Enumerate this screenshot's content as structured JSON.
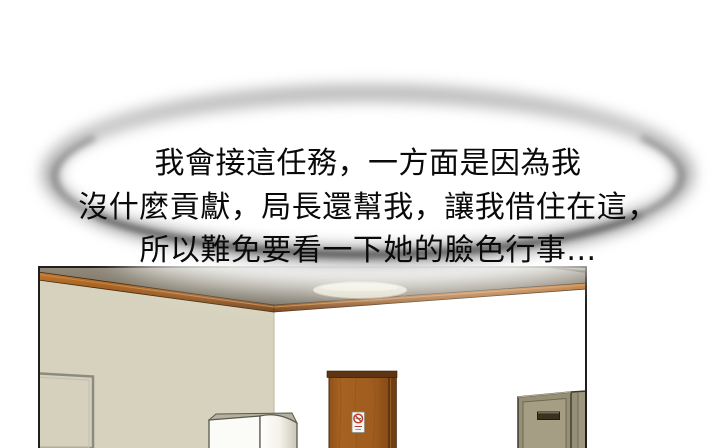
{
  "speech": {
    "lines": [
      "我會接這任務，一方面是因為我",
      "沒什麼貢獻，局長還幫我，讓我借住在這，",
      "所以難免要看一下她的臉色行事..."
    ],
    "text_color": "#0a0a0a",
    "bubble_fill": "#ffffff",
    "bubble_ring_color": "#8e8e8e",
    "bubble_bottom_arc_color": "#3c3c3c"
  },
  "panel": {
    "border_color": "#1f1f1f",
    "room": {
      "colors": {
        "left_wall": "#d7d2bd",
        "right_wall": "#ffffff",
        "ceiling_dark": "#6f6859",
        "molding_wood": "#a35c1e",
        "door_wood": "#a05d1e",
        "door_frame": "#5e3514",
        "left_door_fill": "#d6d1bc",
        "left_door_frame": "#8b8b7f",
        "white_cabinet_front": "#fbfbf8",
        "cabinet_top_face": "#b5b1a1",
        "storage_cabinet_body": "#968f77",
        "storage_cabinet_face": "#a59e85",
        "storage_cabinet_handle": "#39321f",
        "light_fixture": "#d6d1ba",
        "sign_red": "#c43b2a",
        "sign_fill": "#f6f5f1"
      }
    }
  }
}
